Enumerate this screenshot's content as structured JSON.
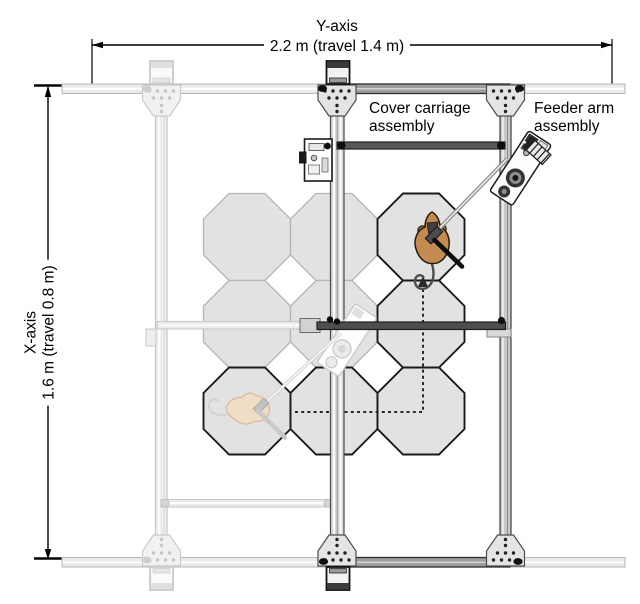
{
  "labels": {
    "y_axis": {
      "name": "Y-axis",
      "dimension": "2.2 m (travel 1.4 m)"
    },
    "x_axis": {
      "name": "X-axis",
      "dimension": "1.6 m (travel 0.8 m)"
    },
    "cover_carriage": {
      "line1": "Cover carriage",
      "line2": "assembly"
    },
    "feeder_arm": {
      "line1": "Feeder arm",
      "line2": "assembly"
    }
  },
  "maze": {
    "tile_shape": "octagon",
    "tile_width_px": 87,
    "col_centers_x": [
      247,
      334,
      421
    ],
    "row_centers_y": [
      237,
      324,
      411
    ],
    "fill": "#e2e2e2",
    "active_stroke": "#1a1a1a",
    "inactive_stroke": "#b4b4b4",
    "tiles": [
      {
        "col": 0,
        "row": 0,
        "state": "inactive"
      },
      {
        "col": 1,
        "row": 0,
        "state": "inactive"
      },
      {
        "col": 2,
        "row": 0,
        "state": "active"
      },
      {
        "col": 0,
        "row": 1,
        "state": "inactive"
      },
      {
        "col": 1,
        "row": 1,
        "state": "inactive"
      },
      {
        "col": 2,
        "row": 1,
        "state": "active"
      },
      {
        "col": 0,
        "row": 2,
        "state": "active"
      },
      {
        "col": 1,
        "row": 2,
        "state": "active"
      },
      {
        "col": 2,
        "row": 2,
        "state": "active"
      }
    ]
  },
  "travel_path": {
    "style": "dashed",
    "color": "#2a2a2a",
    "points": [
      [
        295,
        412
      ],
      [
        423,
        412
      ],
      [
        423,
        285
      ]
    ],
    "arrow": "up"
  },
  "mice": {
    "current": {
      "x": 432,
      "y": 240,
      "heading": "up",
      "body_color": "#c18b52",
      "ghost": false
    },
    "previous": {
      "x": 249,
      "y": 410,
      "heading": "left",
      "body_color": "#f0ddc5",
      "ghost": true
    }
  },
  "colors": {
    "background": "#ffffff",
    "rail_light": "#eaeaea",
    "rail_dark_segment": "#9d9d9d",
    "frame_bar": "#585858",
    "cover_bar": "#4e4e4e",
    "ghost_gray": "#ececec",
    "text": "#000000"
  }
}
